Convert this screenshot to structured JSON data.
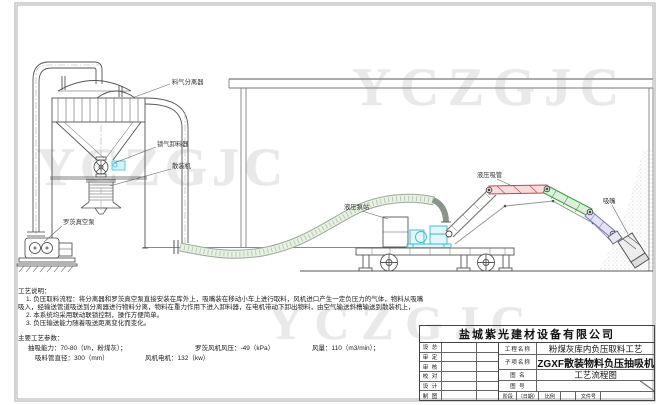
{
  "drawing": {
    "watermark_text": "YCZGJC",
    "equipment_labels": {
      "separator": "料气分离器",
      "airlock_discharger": "锁气卸料器",
      "bulk_loader": "散装机",
      "roots_vacuum_pump": "罗茨真空泵",
      "hydraulic_pump_station": "液压泵站",
      "hydraulic_suction_pipe": "液压吸管",
      "suction_nozzle": "吸嘴"
    },
    "process_notes": {
      "title": "工艺说明：",
      "line1": "1. 负压取料流程：将分离器和罗茨真空泵直接安装在库外上，吸嘴装在移动小车上进行取料，风机进口产生一定负压力的气体，物料从吸嘴",
      "line2": "吸入，经输送管道吸送到分离器进行物料分离，物料在重力作用下进入卸料器，在电机带动下卸出物料，由空气输送斜槽输送到散装机上，",
      "line3": "2. 本系统均采用联动联锁控制，操作方便简单。",
      "line4": "3. 负压输送能力随着吸送距离变化而变化。"
    },
    "process_params": {
      "title": "主要工艺参数：",
      "capacity": "抽吸能力：70-80（t/h，粉煤灰）；",
      "fan_pressure": "罗茨风机风压：-49（kPa）",
      "air_volume": "风量：110（m3/min）；",
      "pipe_diameter": "吸料管直径：300（mm）",
      "fan_motor": "风机电机：132（kw）"
    },
    "title_block": {
      "company": "盐城紫光建材设备有限公司",
      "sign_rows": [
        "设 总",
        "审 定",
        "审 核",
        "校 对",
        "设 计",
        "制 图"
      ],
      "project_label": "工程名称",
      "project_name": "粉煤灰库内负压取料工艺",
      "subitem_label": "子项名称",
      "subitem_name": "ZGXF散装物料负压抽吸机",
      "drawing_name_label": "图 名",
      "drawing_name": "工艺流程图",
      "drawing_no_label": "图 号",
      "drawing_no": "",
      "stage_label": "阶段",
      "date_label": "（日期）",
      "scale_label": "比例",
      "file_no_label": "文件号"
    },
    "colors": {
      "line": "#555555",
      "cyan_equipment": "#35c4dd",
      "arm_red": "#cc4444",
      "arm_green": "#3aa13a",
      "arm_blue": "#7777cc",
      "hose_fill": "#e9f1e3",
      "watermark": "#e9e9e9"
    }
  }
}
